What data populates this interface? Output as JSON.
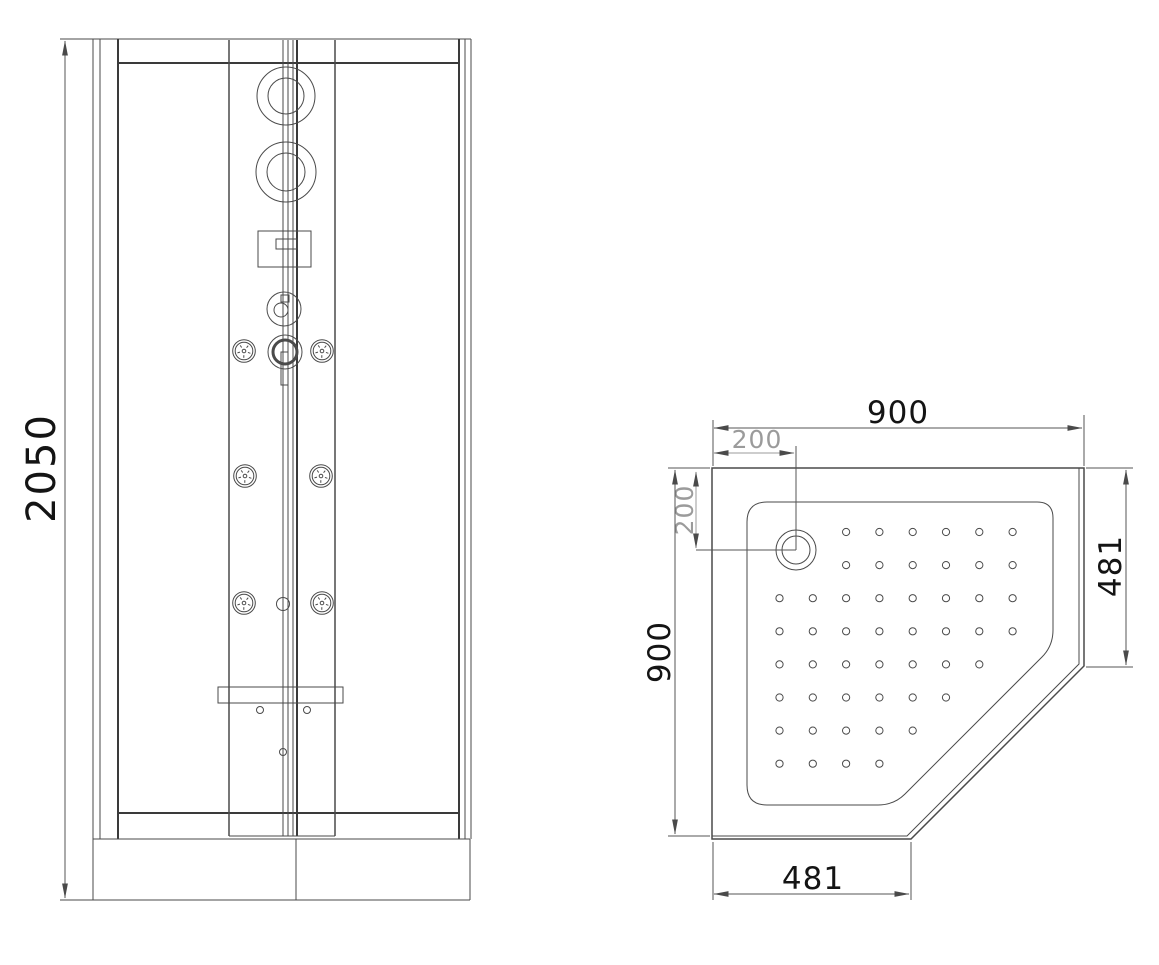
{
  "drawing": {
    "type": "technical-drawing",
    "subject": "corner shower cabin - front elevation and shower tray plan",
    "elevation": {
      "overall_height": "2050"
    },
    "plan": {
      "overall_width": "900",
      "overall_depth": "900",
      "drain_offset_horizontal": "200",
      "drain_offset_vertical": "200",
      "side_panel_width": "481",
      "front_panel_width": "481"
    },
    "colors": {
      "line": "#4a4a4a",
      "line_heavy": "#3a3a3a",
      "dim": "#555555",
      "dim_gray": "#9b9b9b",
      "text": "#141414"
    },
    "dot_grid": {
      "start_x": 779.5,
      "start_y": 532,
      "spacing_x": 33.3,
      "spacing_y": 33.1,
      "radius": 3.6,
      "rows": [
        [
          3,
          8
        ],
        [
          3,
          8
        ],
        [
          1,
          8
        ],
        [
          1,
          8
        ],
        [
          1,
          7
        ],
        [
          1,
          6
        ],
        [
          1,
          5
        ],
        [
          1,
          4
        ]
      ]
    }
  }
}
